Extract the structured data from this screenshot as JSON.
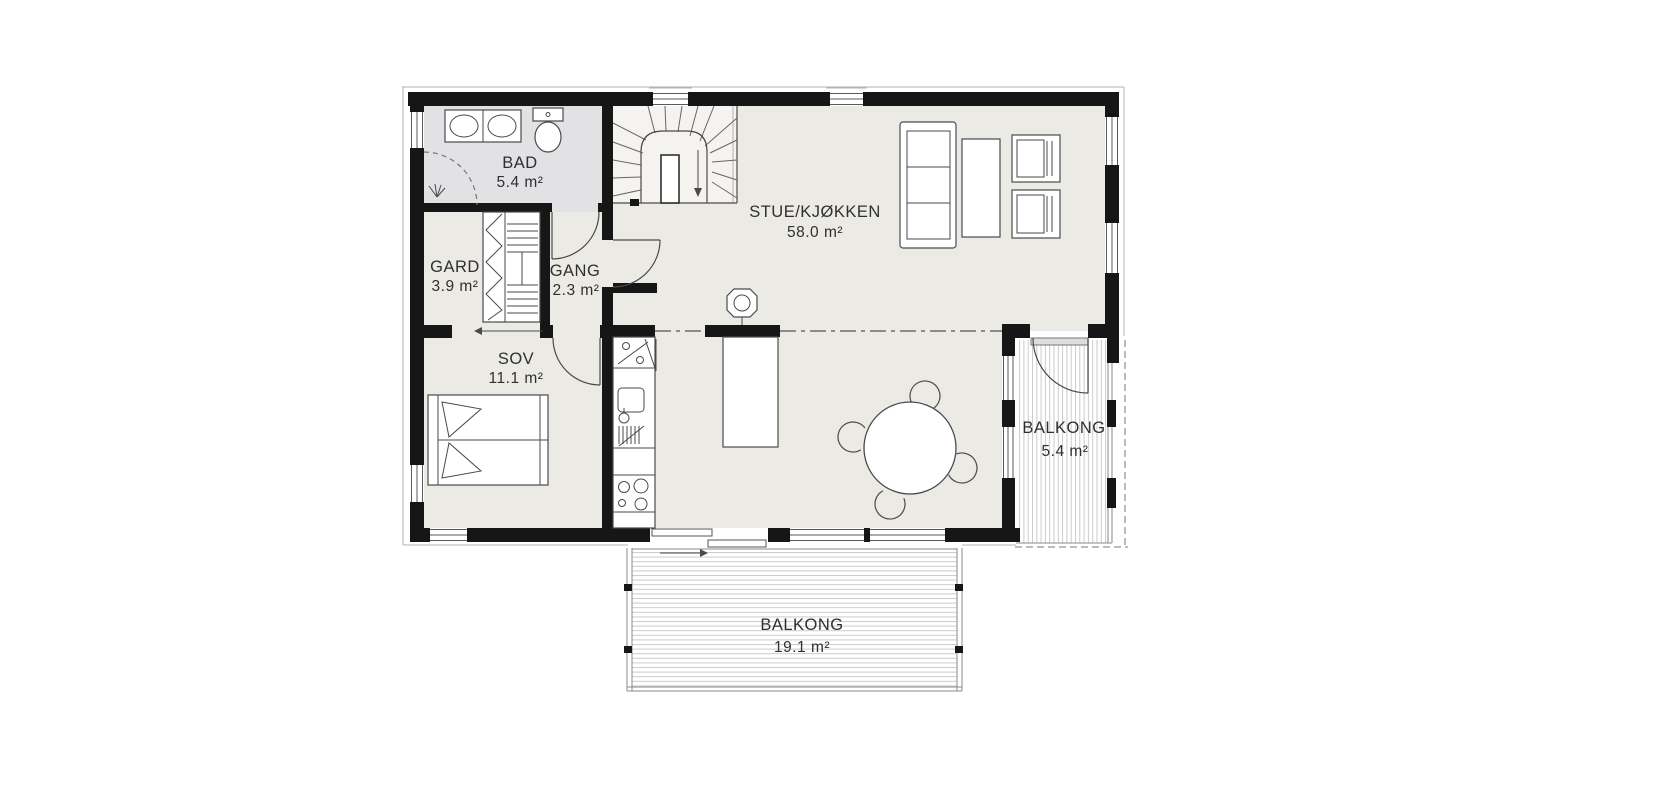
{
  "rooms": [
    {
      "id": "bad",
      "name": "BAD",
      "area": "5.4 m²"
    },
    {
      "id": "gard",
      "name": "GARD",
      "area": "3.9 m²"
    },
    {
      "id": "gang",
      "name": "GANG",
      "area": "2.3 m²"
    },
    {
      "id": "sov",
      "name": "SOV",
      "area": "11.1 m²"
    },
    {
      "id": "stue_kjokken",
      "name": "STUE/KJØKKEN",
      "area": "58.0 m²"
    },
    {
      "id": "balkong_east",
      "name": "BALKONG",
      "area": "5.4 m²"
    },
    {
      "id": "balkong_south",
      "name": "BALKONG",
      "area": "19.1 m²"
    }
  ],
  "colors": {
    "wall": "#161616",
    "floor": "#ebeae5",
    "bathroom_floor": "#e2e2e5",
    "stair_floor": "#f4f3f0",
    "drawing_line": "#4a4a4a",
    "deck_line": "#cbcbcb",
    "label_text": "#2f2f2f"
  }
}
